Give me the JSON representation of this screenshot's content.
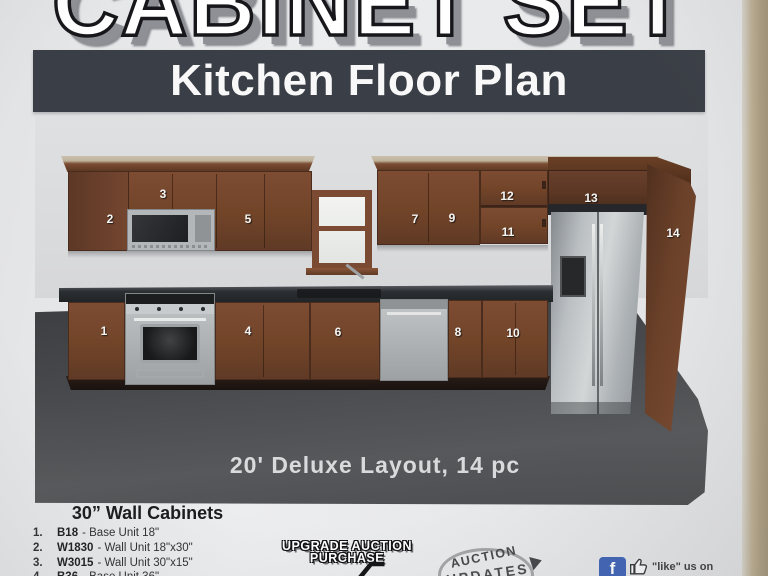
{
  "photo": {
    "title": "CABINET SET",
    "banner_text": "Kitchen Floor Plan"
  },
  "scene": {
    "caption": "20' Deluxe Layout, 14 pc",
    "cabinet_labels": [
      "1",
      "2",
      "3",
      "4",
      "5",
      "6",
      "7",
      "8",
      "9",
      "10",
      "11",
      "12",
      "13",
      "14"
    ]
  },
  "legend": {
    "heading": "30” Wall Cabinets",
    "items": [
      {
        "num": "1.",
        "code": "B18",
        "desc": "- Base Unit 18\""
      },
      {
        "num": "2.",
        "code": "W1830",
        "desc": "- Wall Unit 18\"x30\""
      },
      {
        "num": "3.",
        "code": "W3015",
        "desc": "- Wall Unit 30\"x15\""
      },
      {
        "num": "4.",
        "code": "B36",
        "desc": "- Base Unit 36\""
      }
    ]
  },
  "badges": {
    "upgrade_line1": "UPGRADE AUCTION",
    "upgrade_line2": "PURCHASE",
    "updates_line1": "AUCTION",
    "updates_line2": "UPDATES",
    "facebook_f": "f",
    "facebook_like": "\"like\" us on"
  },
  "colors": {
    "banner_bg": "#3a3e46",
    "cabinet_brown": "#7a4a32",
    "floor_gray": "#4b4e51",
    "counter_black": "#2c2f32",
    "facebook_blue": "#3f63b5",
    "paper": "#e8e9eb",
    "table_tan": "#ab9d82"
  }
}
